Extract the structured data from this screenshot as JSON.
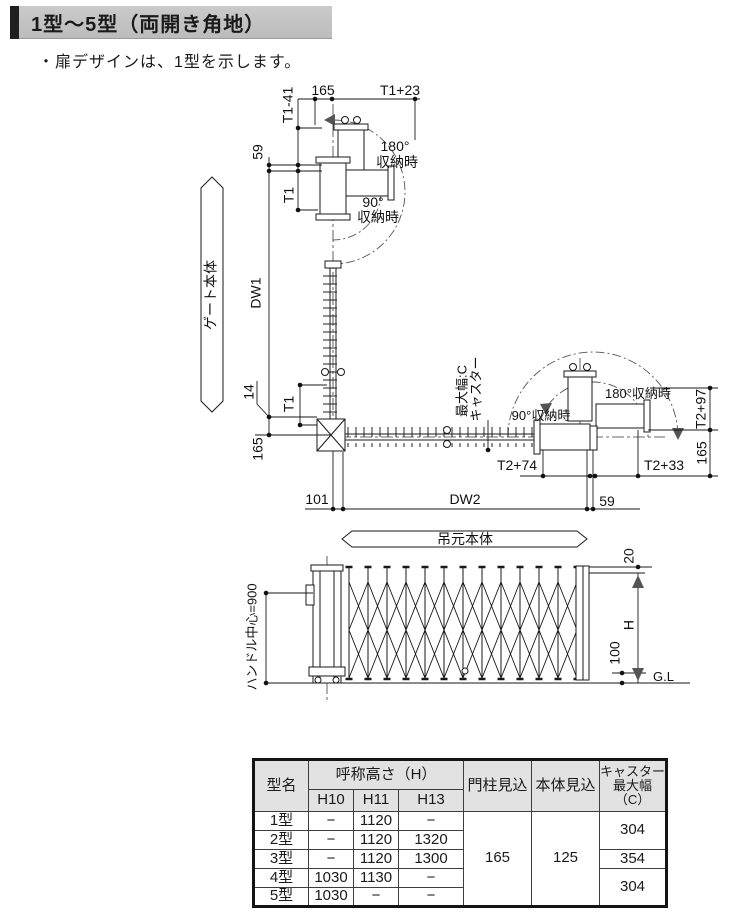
{
  "header": {
    "title": "1型～5型（両開き角地）"
  },
  "note": "・扉デザインは、1型を示します。",
  "plan": {
    "gate_body": "ゲート本体",
    "hinge_body": "吊元本体",
    "dims": {
      "d165_top": "165",
      "t1_plus_23": "T1+23",
      "t1_minus_41": "T1-41",
      "d59_upper": "59",
      "t1_upper": "T1",
      "dw1": "DW1",
      "d14": "14",
      "t1_lower": "T1",
      "d165_lower": "165",
      "d101": "101",
      "dw2": "DW2",
      "d59_lower": "59",
      "t2_plus_74": "T2+74",
      "t2_plus_33": "T2+33",
      "t2_plus_97": "T2+97",
      "d165_right": "165"
    },
    "labels": {
      "deg180": "180°",
      "deg90": "90°",
      "stow": "収納時",
      "stow90_right": "90°収納時",
      "stow180_right": "180°収納時",
      "caster_line1": "キャスター",
      "caster_line2": "最大幅:C"
    }
  },
  "elevation": {
    "handle_center": "ハンドル中心=900",
    "d20": "20",
    "h_label": "H",
    "d100": "100",
    "gl": "G.L"
  },
  "table": {
    "headers": {
      "model": "型名",
      "height_group": "呼称高さ（H）",
      "h10": "H10",
      "h11": "H11",
      "h13": "H13",
      "pillar_depth": "門柱見込",
      "body_depth": "本体見込",
      "caster_l1": "キャスター",
      "caster_l2": "最大幅",
      "caster_l3": "（C）"
    },
    "rows": [
      {
        "model": "1型",
        "h10": "−",
        "h11": "1120",
        "h13": "−"
      },
      {
        "model": "2型",
        "h10": "−",
        "h11": "1120",
        "h13": "1320"
      },
      {
        "model": "3型",
        "h10": "−",
        "h11": "1120",
        "h13": "1300"
      },
      {
        "model": "4型",
        "h10": "1030",
        "h11": "1130",
        "h13": "−"
      },
      {
        "model": "5型",
        "h10": "1030",
        "h11": "−",
        "h13": "−"
      }
    ],
    "pillar_value": "165",
    "body_value": "125",
    "caster_values": [
      "304",
      "354",
      "304"
    ]
  }
}
